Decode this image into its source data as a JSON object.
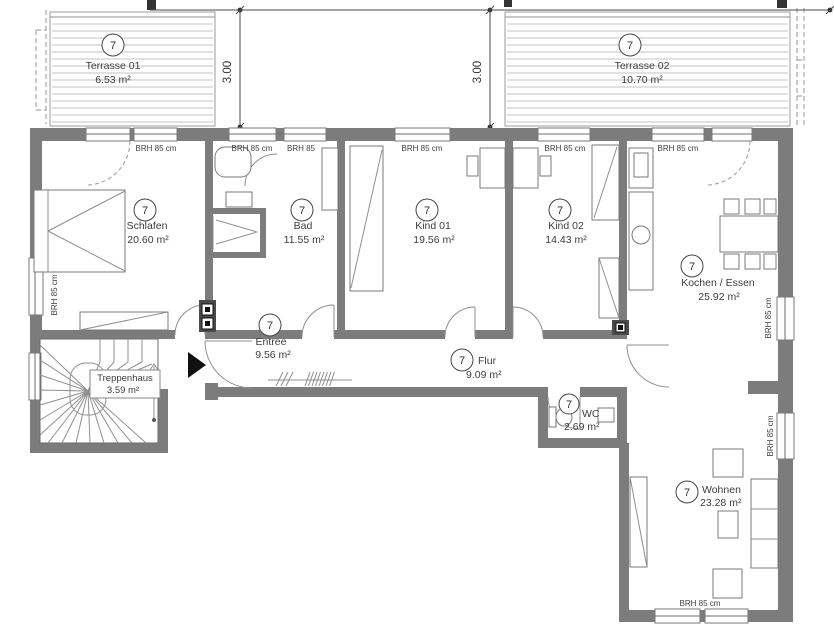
{
  "drawing": {
    "rooms": [
      {
        "key": "terrasse01",
        "number": "7",
        "name": "Terrasse 01",
        "area": "6.53 m²"
      },
      {
        "key": "terrasse02",
        "number": "7",
        "name": "Terrasse 02",
        "area": "10.70 m²"
      },
      {
        "key": "schlafen",
        "number": "7",
        "name": "Schlafen",
        "area": "20.60 m²"
      },
      {
        "key": "bad",
        "number": "7",
        "name": "Bad",
        "area": "11.55 m²"
      },
      {
        "key": "kind01",
        "number": "7",
        "name": "Kind 01",
        "area": "19.56 m²"
      },
      {
        "key": "kind02",
        "number": "7",
        "name": "Kind 02",
        "area": "14.43 m²"
      },
      {
        "key": "kochen",
        "number": "7",
        "name": "Kochen / Essen",
        "area": "25.92 m²"
      },
      {
        "key": "entree",
        "number": "7",
        "name": "Entree",
        "area": "9.56 m²"
      },
      {
        "key": "flur",
        "number": "7",
        "name": "Flur",
        "area": "9.09 m²"
      },
      {
        "key": "wc",
        "number": "7",
        "name": "WC",
        "area": "2.69 m²"
      },
      {
        "key": "wohnen",
        "number": "7",
        "name": "Wohnen",
        "area": "23.28 m²"
      },
      {
        "key": "treppenhaus",
        "name": "Treppenhaus",
        "area": "3.59 m²"
      }
    ],
    "window_labels": {
      "standard": "BRH 85 cm",
      "short": "BRH 85"
    },
    "dimensions": {
      "terrace_depth": "3.00"
    },
    "colors": {
      "wall": "#7c7c7c",
      "thin_line": "#6b6b6b",
      "deck_line": "#c3c3c3",
      "text": "#3d3d3d",
      "marker": "#333333"
    }
  }
}
